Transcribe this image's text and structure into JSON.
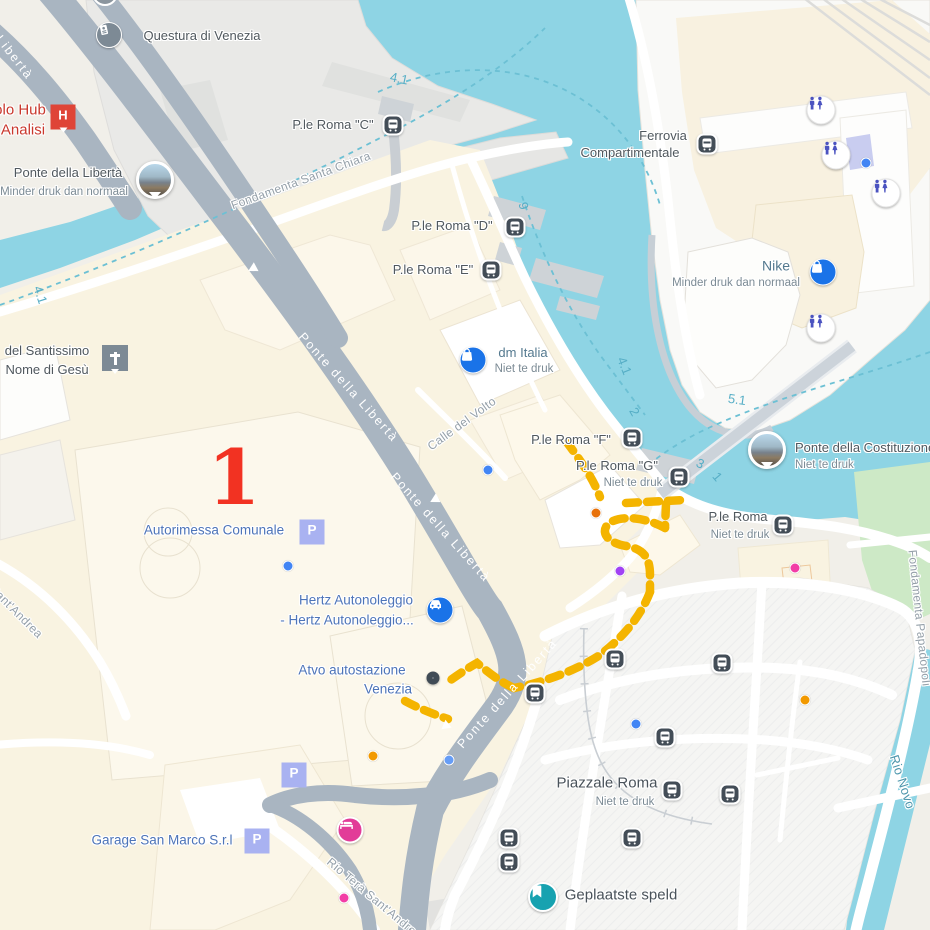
{
  "annotation": {
    "step_number": "1"
  },
  "colors": {
    "water": "#8ed4e4",
    "route_yellow": "#f4b400",
    "marker_red": "#f23222",
    "road_gray": "#a9b5c1",
    "park_green": "#c6e6c3",
    "transit_dark": "#434d57",
    "poi_blue": "#1a73e8",
    "parking_lavender": "#a9b2f1",
    "toilet_purple": "#4b53c0",
    "pin_teal": "#17a2b0",
    "pin_pink": "#e23c98",
    "hospital_red": "#df4437"
  },
  "icons": {
    "parking_glyph": "P",
    "hospital_glyph": "H"
  },
  "pois": {
    "questura": {
      "name": "Questura di Venezia"
    },
    "hospital": {
      "line1": "olo Hub",
      "line2": "Analisi"
    },
    "ponte_liberta": {
      "name": "Ponte della Libertà",
      "busyness": "Minder druk dan normaal"
    },
    "santissimo": {
      "line1": "del Santissimo",
      "line2": "Nome di Gesù"
    },
    "dm_italia": {
      "name": "dm Italia",
      "busyness": "Niet te druk"
    },
    "nike": {
      "name": "Nike",
      "busyness": "Minder druk dan normaal"
    },
    "autorimessa": {
      "name": "Autorimessa Comunale"
    },
    "hertz": {
      "line1": "Hertz Autonoleggio",
      "line2": "- Hertz Autonoleggio..."
    },
    "atvo": {
      "line1": "Atvo autostazione",
      "line2": "Venezia"
    },
    "garage": {
      "name": "Garage San Marco S.r.l"
    },
    "piazzale_roma": {
      "name": "Piazzale Roma",
      "busyness": "Niet te druk"
    },
    "costituzione": {
      "name": "Ponte della Costituzione",
      "busyness": "Niet te druk"
    },
    "geplaatste_speld": {
      "name": "Geplaatste speld"
    }
  },
  "stops": {
    "roma_c": "P.le Roma \"C\"",
    "roma_d": "P.le Roma \"D\"",
    "roma_e": "P.le Roma \"E\"",
    "roma_f": "P.le Roma \"F\"",
    "roma_g": {
      "name": "P.le Roma \"G\"",
      "busyness": "Niet te druk"
    },
    "roma": {
      "name": "P.le Roma",
      "busyness": "Niet te druk"
    },
    "ferrovia": {
      "line1": "Ferrovia",
      "line2": "Compartimentale"
    }
  },
  "streets": {
    "fondamenta_santa_chiara": "Fondamenta Santa Chiara",
    "calle_del_volto": "Calle del Volto",
    "ponte_della_liberta": "Ponte della Libertà",
    "liberta": "Libertà",
    "rio_tera_sant_andrea": "Rio Terà Sant'Andrea",
    "sant_andrea": "Sant'Andrea",
    "fondamenta_papadopoli": "Fondamenta Papadopoli",
    "rio_novo": "Rio Novo"
  },
  "water_depths": {
    "d1": "4.1",
    "d2": "9",
    "d3": "4.1",
    "d4": "4.1",
    "d5": "2",
    "d6": "5.1",
    "d7": "3",
    "d8": "1"
  }
}
